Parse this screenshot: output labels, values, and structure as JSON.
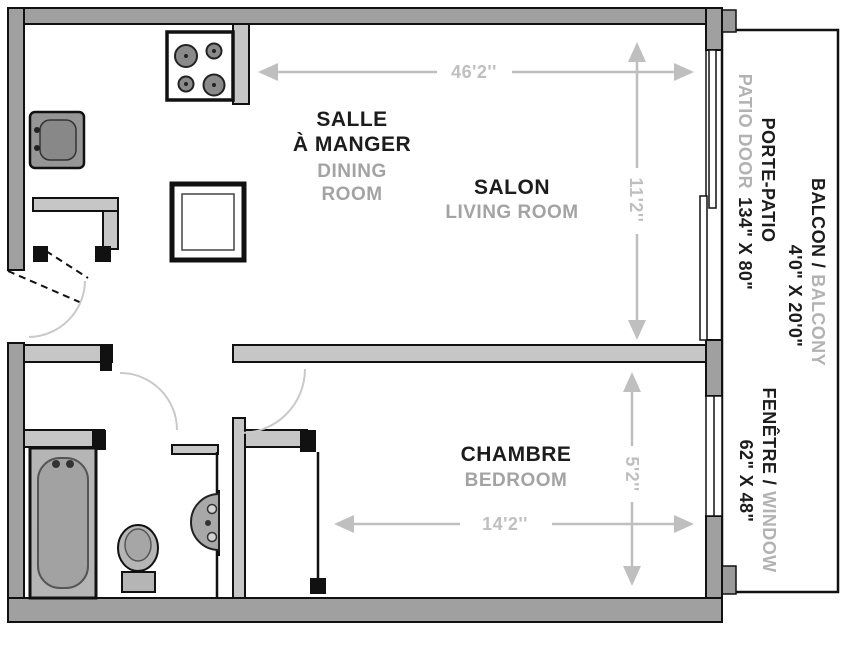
{
  "plan_title": "one-bedroom-apartment-floor-plan",
  "rooms": {
    "dining": {
      "fr_line1": "SALLE",
      "fr_line2": "À MANGER",
      "en_line1": "DINING",
      "en_line2": "ROOM"
    },
    "living": {
      "fr": "SALON",
      "en": "LIVING ROOM"
    },
    "bedroom": {
      "fr": "CHAMBRE",
      "en": "BEDROOM"
    }
  },
  "dimensions": {
    "living_width": "46'2''",
    "patio_door_height": "11'2''",
    "bedroom_width": "14'2''",
    "window_height": "5'2''"
  },
  "annotations": {
    "patio_door": {
      "fr": "PORTE-PATIO",
      "en": "PATIO DOOR",
      "size": "134\" X 80\""
    },
    "balcony": {
      "fr": "BALCON /",
      "en": "BALCONY",
      "size": "4'0\" X 20'0\""
    },
    "window": {
      "fr": "FENÊTRE /",
      "en": "WINDOW",
      "size": "62\" X 48\""
    }
  },
  "colors": {
    "label_black": "#1c1c1c",
    "label_gray": "#a3a3a3",
    "dimension_gray": "#bfbfbf",
    "wall_gray": "#a0a0a0",
    "interior_wall_gray": "#c6c6c6",
    "fixture_gray": "#b0b0b0"
  }
}
